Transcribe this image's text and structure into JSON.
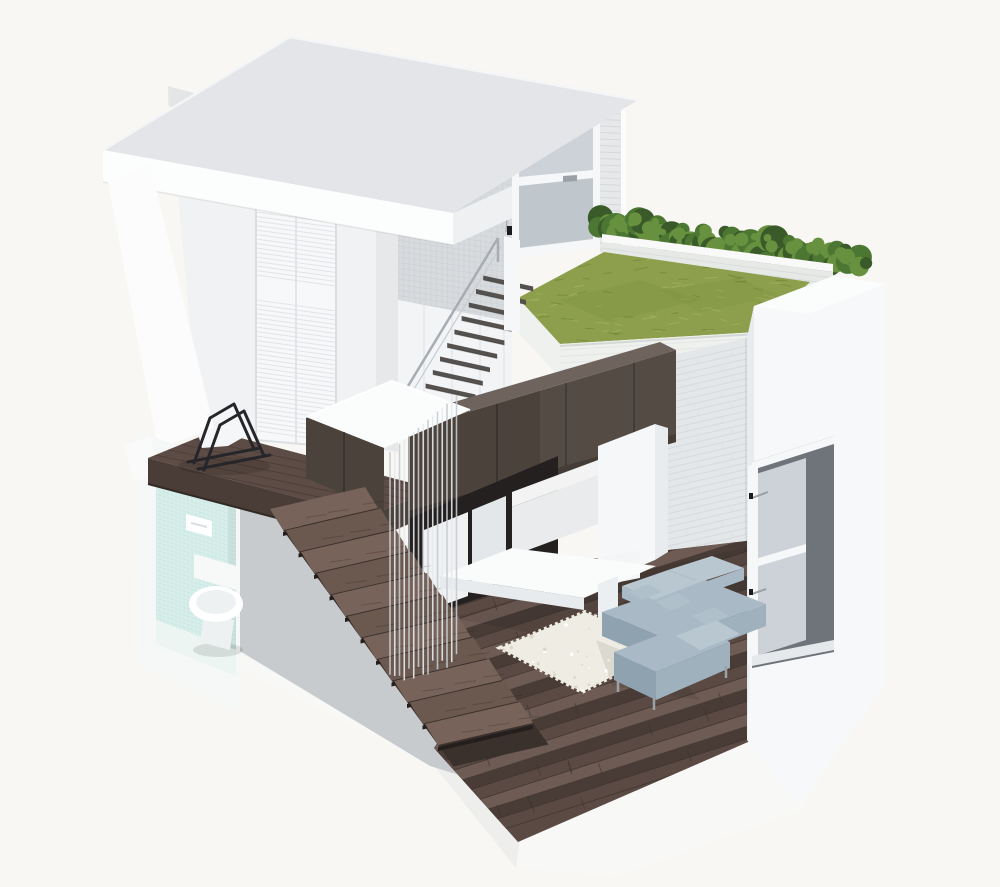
{
  "meta": {
    "title": "Micro-loft apartment cutaway",
    "description": "Isometric 3D cutaway rendering of a small multi-level loft apartment with roof terrace, staircase, mezzanine, bathroom and living area",
    "view": "isometric-cutaway-render"
  },
  "colors": {
    "background": "#f8f7f4",
    "roofTop": "#e3e5e8",
    "roofFasciaSW": "#fcfdfd",
    "roofFasciaSE": "#eef0f2",
    "wallPanel": "#f0f2f4",
    "wallBright": "#fcfcfd",
    "doorWhite": "#f7f8fa",
    "doorSeam": "#dcdfe2",
    "mosaic": "#d8dbde",
    "mosaicLine": "#c6cacd",
    "frameWhite": "#f6f7f8",
    "glass": "#ccd2d7",
    "glassDim": "#bfc6cc",
    "handleGray": "#9ba1a6",
    "brickCol": "#e6e8e9",
    "brickLiving": "#e4e7e9",
    "brickLine": "#d2d6d9",
    "parapetBrick": "#e7e9e7",
    "parapetTop": "#f8f9f8",
    "hedge": "#4c7733",
    "hedgeLight": "#67913f",
    "hedgeDark": "#3a5a2a",
    "grass": "#8d9f4c",
    "grassLight": "#a3b160",
    "grassDark": "#74893d",
    "fasciaWhite": "#eff1ef",
    "panel": "#f2f4f6",
    "panelSeam": "#e1e4e8",
    "treadUpper": "#55514e",
    "railGray": "#a7adb2",
    "woodTrim": "#6f645d",
    "woodFront": "#4c423c",
    "woodSeam": "#352e2a",
    "woodDarkEdge": "#3a322d",
    "bedWhite": "#fbfcfc",
    "voidDark": "#242020",
    "wardrobe": "#eff1f2",
    "wardrobeDim": "#e4e7e9",
    "counterWhite": "#f2f3f2",
    "cabinetWhite": "#e9ebec",
    "columnWhite": "#f6f7f8",
    "columnSide": "#e9ecee",
    "deskTop": "#fafbfb",
    "deskEdge": "#e8ebed",
    "deskLeg": "#eceff1",
    "grayCut": "#c8cbce",
    "bathFrame": "#f6f7f7",
    "tile": "#d9efec",
    "tileLine": "#bcdcd6",
    "bathFloor": "#edf5f3",
    "fixtureWhite": "#ffffff",
    "porcelainShade": "#eef1f1",
    "tankWhite": "#f7f8f8",
    "plinth": "#f8f8f7",
    "mezzWood": "#5d4c45",
    "mezzWoodDark": "#4a3c36",
    "mezzEdgeDark": "#332a26",
    "plankLight": "#6e5c54",
    "plankDark": "#493c37",
    "floorWood": "#5a4a43",
    "nosingDark": "#241e1c",
    "riser": "#3a302c",
    "treadWood": "#6b5950",
    "treadWoodLight": "#776359",
    "cableLight": "#e8ebee",
    "cableDark": "#c7ccd0",
    "rug": "#efece3",
    "rugSpeckle": "#ded7c6",
    "wallWhite": "#f7f8f9",
    "wallTopFace": "#fbfcfc",
    "wallEdge": "#e9ecee",
    "reveal": "#6e747a",
    "sill": "#e6e9eb",
    "sofa": "#a9bac6",
    "sofaLight": "#b9c7d1",
    "sofaMid": "#9fb1bd",
    "sofaShadow": "#8fa2b0",
    "pillow": "#b0c0cb",
    "chairFrame": "#26262a",
    "chairSeat": "#f4f6f7",
    "ledgeWhite": "#fafafa",
    "baseCab": "#f3f5f6",
    "hardwareBlack": "#1c1c1e"
  },
  "scene": {
    "objects": [
      {
        "name": "roof-slab",
        "label": "Roof slab"
      },
      {
        "name": "closet-wall",
        "label": "Upper bedroom wall with louvered closet doors"
      },
      {
        "name": "mosaic-wall",
        "label": "Mosaic tile stair wall"
      },
      {
        "name": "terrace-door",
        "label": "Glass door to roof terrace"
      },
      {
        "name": "brick-column",
        "label": "White brick pier"
      },
      {
        "name": "hedge",
        "label": "Roof terrace hedge planting"
      },
      {
        "name": "parapet",
        "label": "White brick parapet"
      },
      {
        "name": "green-roof",
        "label": "Grass roof terrace"
      },
      {
        "name": "living-brick-wall",
        "label": "Living room brick wall"
      },
      {
        "name": "panel-wall",
        "label": "White paneled wall under upper stair"
      },
      {
        "name": "upper-staircase",
        "label": "Upper floating stair to terrace"
      },
      {
        "name": "loft-volume",
        "label": "Espresso wood loft-bed cabinetry volume"
      },
      {
        "name": "loft-bed",
        "label": "White loft bed top"
      },
      {
        "name": "wardrobe",
        "label": "Wardrobe under loft"
      },
      {
        "name": "kitchen-counter",
        "label": "Kitchen cabinetry"
      },
      {
        "name": "desk",
        "label": "White cantilevered desk"
      },
      {
        "name": "cable-screen",
        "label": "Suspended cable balustrade screen"
      },
      {
        "name": "main-staircase",
        "label": "Dark wood main staircase"
      },
      {
        "name": "mezzanine",
        "label": "Mezzanine platform"
      },
      {
        "name": "lounge-chair",
        "label": "Black frame lounge chair"
      },
      {
        "name": "bathroom",
        "label": "Bathroom niche with aqua mosaic tile"
      },
      {
        "name": "toilet",
        "label": "Wall-hung toilet"
      },
      {
        "name": "flush-plate",
        "label": "Flush plate"
      },
      {
        "name": "main-floor",
        "label": "Dark hardwood living room floor"
      },
      {
        "name": "rug",
        "label": "White shag rug"
      },
      {
        "name": "sofa",
        "label": "Gray sectional sofa"
      },
      {
        "name": "window",
        "label": "Deep-reveal window in thick wall"
      },
      {
        "name": "right-wall",
        "label": "Thick white side wall"
      },
      {
        "name": "plinth",
        "label": "White base slab"
      }
    ]
  }
}
